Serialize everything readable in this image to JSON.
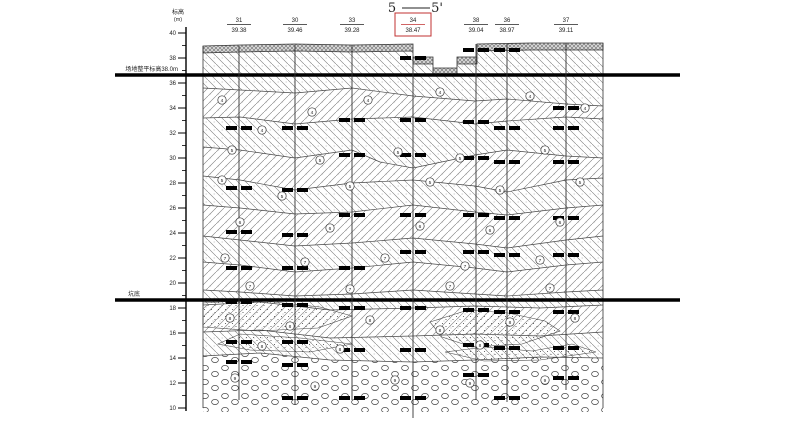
{
  "title": {
    "left": "5",
    "right": "5'"
  },
  "axis": {
    "label": "标高",
    "unit": "(m)",
    "x": 186,
    "y0": 33,
    "px_per_m": 12.5,
    "elev_max": 40,
    "elev_min": 10,
    "step": 2
  },
  "accent_red": "#c03030",
  "annotations": [
    {
      "text": "场地整平标高38.0m",
      "x": 178,
      "y": 71
    },
    {
      "text": "坑底",
      "x": 140,
      "y": 296
    }
  ],
  "thick_lines": [
    {
      "y": 75,
      "x1": 115,
      "x2": 680
    },
    {
      "y": 300,
      "x1": 115,
      "x2": 680
    }
  ],
  "boreholes": [
    {
      "x": 239,
      "num": "31",
      "elev": "39.38",
      "top": 46,
      "bottom": 400,
      "red": false,
      "samples": [
        128,
        188,
        232,
        268,
        302,
        342,
        362
      ]
    },
    {
      "x": 295,
      "num": "30",
      "elev": "39.46",
      "top": 45,
      "bottom": 405,
      "red": false,
      "samples": [
        128,
        190,
        235,
        268,
        305,
        342,
        365,
        398
      ]
    },
    {
      "x": 352,
      "num": "33",
      "elev": "39.28",
      "top": 45,
      "bottom": 400,
      "red": false,
      "samples": [
        120,
        155,
        215,
        268,
        308,
        350,
        398
      ]
    },
    {
      "x": 413,
      "num": "34",
      "elev": "38.47",
      "top": 57,
      "bottom": 418,
      "red": true,
      "samples": [
        58,
        120,
        155,
        215,
        252,
        308,
        350,
        398
      ]
    },
    {
      "x": 476,
      "num": "38",
      "elev": "39.04",
      "top": 44,
      "bottom": 400,
      "red": false,
      "samples": [
        50,
        122,
        158,
        215,
        252,
        310,
        345,
        375
      ]
    },
    {
      "x": 507,
      "num": "36",
      "elev": "38.97",
      "top": 44,
      "bottom": 402,
      "red": false,
      "samples": [
        50,
        128,
        162,
        218,
        255,
        312,
        348,
        398
      ]
    },
    {
      "x": 566,
      "num": "37",
      "elev": "39.11",
      "top": 43,
      "bottom": 390,
      "red": false,
      "samples": [
        108,
        128,
        162,
        218,
        255,
        312,
        348,
        378
      ]
    }
  ],
  "section": {
    "left": 203,
    "right": 603,
    "surface": [
      [
        203,
        46
      ],
      [
        240,
        45
      ],
      [
        295,
        44
      ],
      [
        352,
        45
      ],
      [
        413,
        44
      ],
      [
        413,
        57
      ],
      [
        433,
        57
      ],
      [
        433,
        68
      ],
      [
        457,
        68
      ],
      [
        457,
        57
      ],
      [
        477,
        57
      ],
      [
        477,
        44
      ],
      [
        530,
        43
      ],
      [
        566,
        43
      ],
      [
        603,
        43
      ]
    ],
    "fill_band_thickness": 7,
    "boundaries": [
      [
        [
          203,
          88
        ],
        [
          240,
          90
        ],
        [
          295,
          93
        ],
        [
          352,
          88
        ],
        [
          413,
          96
        ],
        [
          475,
          101
        ],
        [
          507,
          99
        ],
        [
          566,
          104
        ],
        [
          603,
          106
        ]
      ],
      [
        [
          203,
          118
        ],
        [
          240,
          117
        ],
        [
          295,
          124
        ],
        [
          352,
          119
        ],
        [
          413,
          117
        ],
        [
          475,
          124
        ],
        [
          507,
          121
        ],
        [
          566,
          117
        ],
        [
          603,
          119
        ]
      ],
      [
        [
          203,
          147
        ],
        [
          240,
          150
        ],
        [
          295,
          158
        ],
        [
          352,
          150
        ],
        [
          380,
          162
        ],
        [
          413,
          168
        ],
        [
          475,
          155
        ],
        [
          507,
          150
        ],
        [
          566,
          156
        ],
        [
          603,
          158
        ]
      ],
      [
        [
          203,
          176
        ],
        [
          240,
          180
        ],
        [
          295,
          190
        ],
        [
          352,
          183
        ],
        [
          413,
          180
        ],
        [
          475,
          186
        ],
        [
          507,
          192
        ],
        [
          566,
          180
        ],
        [
          603,
          178
        ]
      ],
      [
        [
          203,
          205
        ],
        [
          240,
          208
        ],
        [
          295,
          214
        ],
        [
          352,
          212
        ],
        [
          413,
          205
        ],
        [
          475,
          212
        ],
        [
          507,
          215
        ],
        [
          566,
          208
        ],
        [
          603,
          205
        ]
      ],
      [
        [
          203,
          236
        ],
        [
          240,
          240
        ],
        [
          295,
          246
        ],
        [
          352,
          243
        ],
        [
          413,
          238
        ],
        [
          475,
          244
        ],
        [
          507,
          248
        ],
        [
          566,
          240
        ],
        [
          603,
          236
        ]
      ],
      [
        [
          203,
          262
        ],
        [
          240,
          265
        ],
        [
          295,
          272
        ],
        [
          352,
          268
        ],
        [
          413,
          262
        ],
        [
          475,
          268
        ],
        [
          507,
          272
        ],
        [
          566,
          265
        ],
        [
          603,
          262
        ]
      ],
      [
        [
          203,
          290
        ],
        [
          240,
          292
        ],
        [
          295,
          296
        ],
        [
          352,
          294
        ],
        [
          413,
          290
        ],
        [
          475,
          294
        ],
        [
          507,
          296
        ],
        [
          566,
          292
        ],
        [
          603,
          290
        ]
      ],
      [
        [
          203,
          305
        ],
        [
          260,
          302
        ],
        [
          330,
          310
        ],
        [
          413,
          308
        ],
        [
          475,
          306
        ],
        [
          540,
          308
        ],
        [
          603,
          305
        ]
      ],
      [
        [
          203,
          332
        ],
        [
          260,
          330
        ],
        [
          330,
          338
        ],
        [
          413,
          336
        ],
        [
          475,
          334
        ],
        [
          540,
          336
        ],
        [
          603,
          332
        ]
      ],
      [
        [
          203,
          356
        ],
        [
          260,
          353
        ],
        [
          330,
          360
        ],
        [
          413,
          362
        ],
        [
          475,
          360
        ],
        [
          540,
          357
        ],
        [
          603,
          358
        ]
      ],
      [
        [
          203,
          412
        ],
        [
          603,
          412
        ]
      ]
    ],
    "band_patterns": [
      "hA",
      "hB",
      "hA",
      "hB",
      "hA",
      "hB",
      "hA",
      "hB",
      "hA",
      "hB",
      "hA",
      "gravel"
    ],
    "sand_lenses": [
      [
        [
          203,
          303
        ],
        [
          255,
          300
        ],
        [
          320,
          307
        ],
        [
          352,
          316
        ],
        [
          318,
          328
        ],
        [
          258,
          331
        ],
        [
          203,
          327
        ]
      ],
      [
        [
          218,
          344
        ],
        [
          240,
          334
        ],
        [
          300,
          338
        ],
        [
          352,
          344
        ],
        [
          310,
          352
        ],
        [
          250,
          350
        ]
      ],
      [
        [
          430,
          322
        ],
        [
          468,
          310
        ],
        [
          508,
          313
        ],
        [
          545,
          321
        ],
        [
          560,
          331
        ],
        [
          522,
          344
        ],
        [
          472,
          347
        ],
        [
          442,
          337
        ]
      ],
      [
        [
          445,
          352
        ],
        [
          485,
          347
        ],
        [
          532,
          351
        ],
        [
          572,
          344
        ],
        [
          596,
          352
        ],
        [
          540,
          360
        ],
        [
          484,
          361
        ]
      ]
    ],
    "layer_ids": [
      [
        222,
        100,
        "4"
      ],
      [
        262,
        130,
        "4"
      ],
      [
        312,
        112,
        "4"
      ],
      [
        368,
        100,
        "4"
      ],
      [
        440,
        92,
        "4"
      ],
      [
        530,
        96,
        "4"
      ],
      [
        585,
        108,
        "4"
      ],
      [
        232,
        150,
        "5"
      ],
      [
        320,
        160,
        "5"
      ],
      [
        398,
        152,
        "5"
      ],
      [
        460,
        158,
        "5"
      ],
      [
        545,
        150,
        "5"
      ],
      [
        222,
        180,
        "5"
      ],
      [
        282,
        196,
        "5"
      ],
      [
        350,
        186,
        "5"
      ],
      [
        430,
        182,
        "5"
      ],
      [
        500,
        190,
        "5"
      ],
      [
        580,
        182,
        "5"
      ],
      [
        240,
        222,
        "6"
      ],
      [
        330,
        228,
        "6"
      ],
      [
        420,
        226,
        "6"
      ],
      [
        490,
        230,
        "6"
      ],
      [
        560,
        222,
        "6"
      ],
      [
        225,
        258,
        "7"
      ],
      [
        305,
        262,
        "7"
      ],
      [
        385,
        258,
        "7"
      ],
      [
        465,
        266,
        "7"
      ],
      [
        540,
        260,
        "7"
      ],
      [
        250,
        286,
        "7"
      ],
      [
        350,
        289,
        "7"
      ],
      [
        450,
        286,
        "7"
      ],
      [
        550,
        288,
        "7"
      ],
      [
        230,
        318,
        "8"
      ],
      [
        290,
        326,
        "8"
      ],
      [
        370,
        320,
        "8"
      ],
      [
        440,
        330,
        "8"
      ],
      [
        510,
        322,
        "8"
      ],
      [
        575,
        318,
        "8"
      ],
      [
        262,
        346,
        "8"
      ],
      [
        340,
        349,
        "8"
      ],
      [
        480,
        345,
        "8"
      ],
      [
        235,
        378,
        "9"
      ],
      [
        315,
        386,
        "9"
      ],
      [
        395,
        380,
        "9"
      ],
      [
        470,
        383,
        "9"
      ],
      [
        545,
        380,
        "9"
      ]
    ]
  }
}
